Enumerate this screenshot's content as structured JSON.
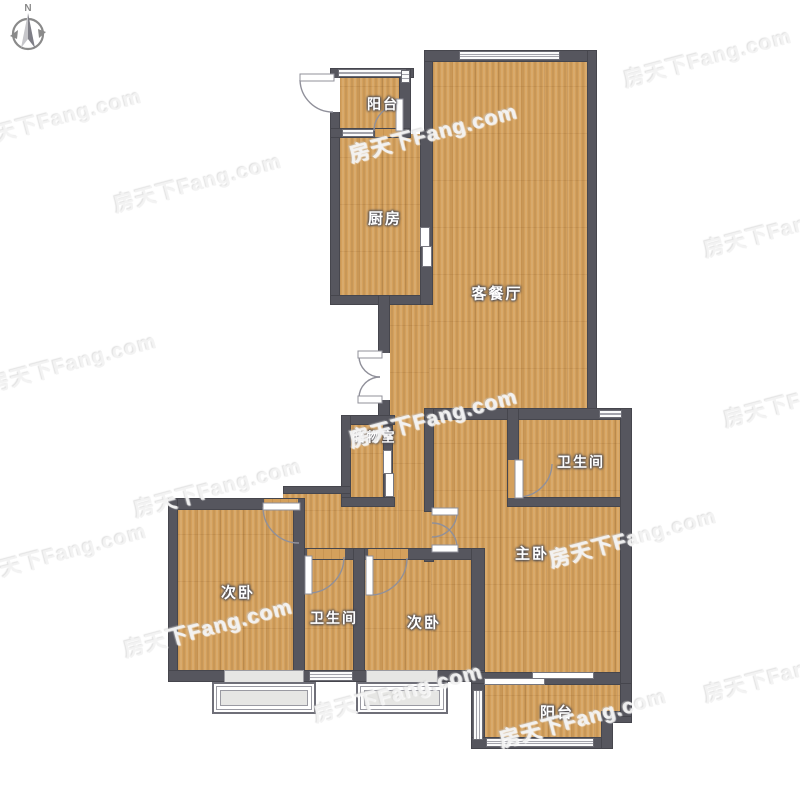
{
  "compass": {
    "north_label": "N"
  },
  "watermark": {
    "text": "房天下Fang.com"
  },
  "rooms": {
    "balcony_top": "阳台",
    "kitchen": "厨房",
    "living_dining": "客餐厅",
    "storage": "储物室",
    "bathroom_master": "卫生间",
    "master_bedroom": "主卧",
    "bedroom_left": "次卧",
    "bathroom_shared": "卫生间",
    "bedroom_middle": "次卧",
    "balcony_bottom": "阳台"
  },
  "colors": {
    "wall": "#56565e",
    "floor_wood": "#d4a05c",
    "window_fill": "#fbfbfb",
    "bay_glass": "#e6e6e4",
    "watermark": "#f0f0f0"
  }
}
